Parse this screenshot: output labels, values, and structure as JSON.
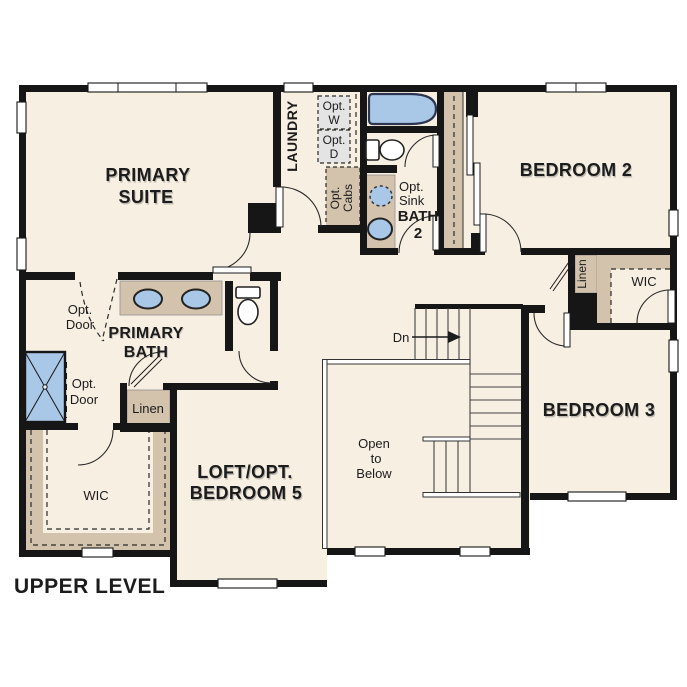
{
  "plan": {
    "title": "UPPER LEVEL",
    "rooms": {
      "primary_suite": {
        "line1": "PRIMARY",
        "line2": "SUITE"
      },
      "laundry": {
        "label": "LAUNDRY"
      },
      "bedroom2": {
        "label": "BEDROOM 2"
      },
      "bedroom3": {
        "label": "BEDROOM 3"
      },
      "loft": {
        "line1": "LOFT/OPT.",
        "line2": "BEDROOM 5"
      },
      "primary_bath": {
        "line1": "PRIMARY",
        "line2": "BATH"
      },
      "bath2": {
        "line1": "BATH",
        "line2": "2"
      },
      "wic_left": {
        "label": "WIC"
      },
      "wic_right": {
        "label": "WIC"
      },
      "linen_left": {
        "label": "Linen"
      },
      "linen_right": {
        "label": "Linen"
      },
      "open_to_below": {
        "line1": "Open",
        "line2": "to",
        "line3": "Below"
      }
    },
    "annotations": {
      "dn": "Dn",
      "opt_w": {
        "line1": "Opt.",
        "line2": "W"
      },
      "opt_d": {
        "line1": "Opt.",
        "line2": "D"
      },
      "opt_cabs": {
        "line1": "Opt.",
        "line2": "Cabs"
      },
      "opt_sink": {
        "line1": "Opt.",
        "line2": "Sink"
      },
      "opt_door_bath": {
        "line1": "Opt.",
        "line2": "Door"
      },
      "opt_door_shower": {
        "line1": "Opt.",
        "line2": "Door"
      }
    },
    "colors": {
      "floor": "#f7efe2",
      "wall": "#161616",
      "cabinet": "#d3c3ad",
      "fixture": "#a9c7e6",
      "fixture_border": "#2e3550",
      "opt_box": "#e4e4e4",
      "text": "#1c1c1c"
    }
  }
}
